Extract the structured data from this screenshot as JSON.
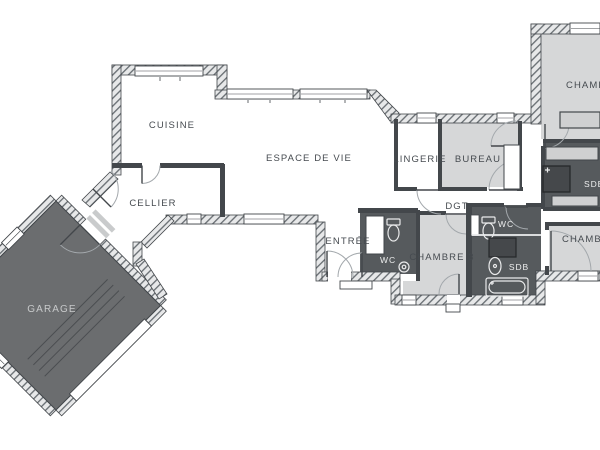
{
  "floorplan": {
    "rooms": {
      "cuisine": {
        "label": "CUISINE"
      },
      "cellier": {
        "label": "CELLIER"
      },
      "garage": {
        "label": "GARAGE"
      },
      "espace_de_vie": {
        "label": "ESPACE DE VIE"
      },
      "entree": {
        "label": "ENTRÉE"
      },
      "wc_entree": {
        "label": "WC"
      },
      "lingerie": {
        "label": "LINGERIE"
      },
      "bureau": {
        "label": "BUREAU"
      },
      "degagement": {
        "label": "DGT"
      },
      "chambre_3": {
        "label": "CHAMBRE 3"
      },
      "wc_bain": {
        "label": "WC"
      },
      "salle_de_bain": {
        "label": "SDB"
      },
      "chambre_haut_droite": {
        "label": "CHAMBRE"
      },
      "salle_de_bain_droite": {
        "label": "SDB"
      },
      "chambre_bas_droite": {
        "label": "CHAMBRE"
      }
    },
    "colors": {
      "background": "#ffffff",
      "room_light": "#d6d7d8",
      "room_dark": "#565a5d",
      "garage_fill": "#6b6d6f",
      "wall": "#43474b",
      "label_dark": "#464b50",
      "label_light": "#eceded"
    }
  }
}
